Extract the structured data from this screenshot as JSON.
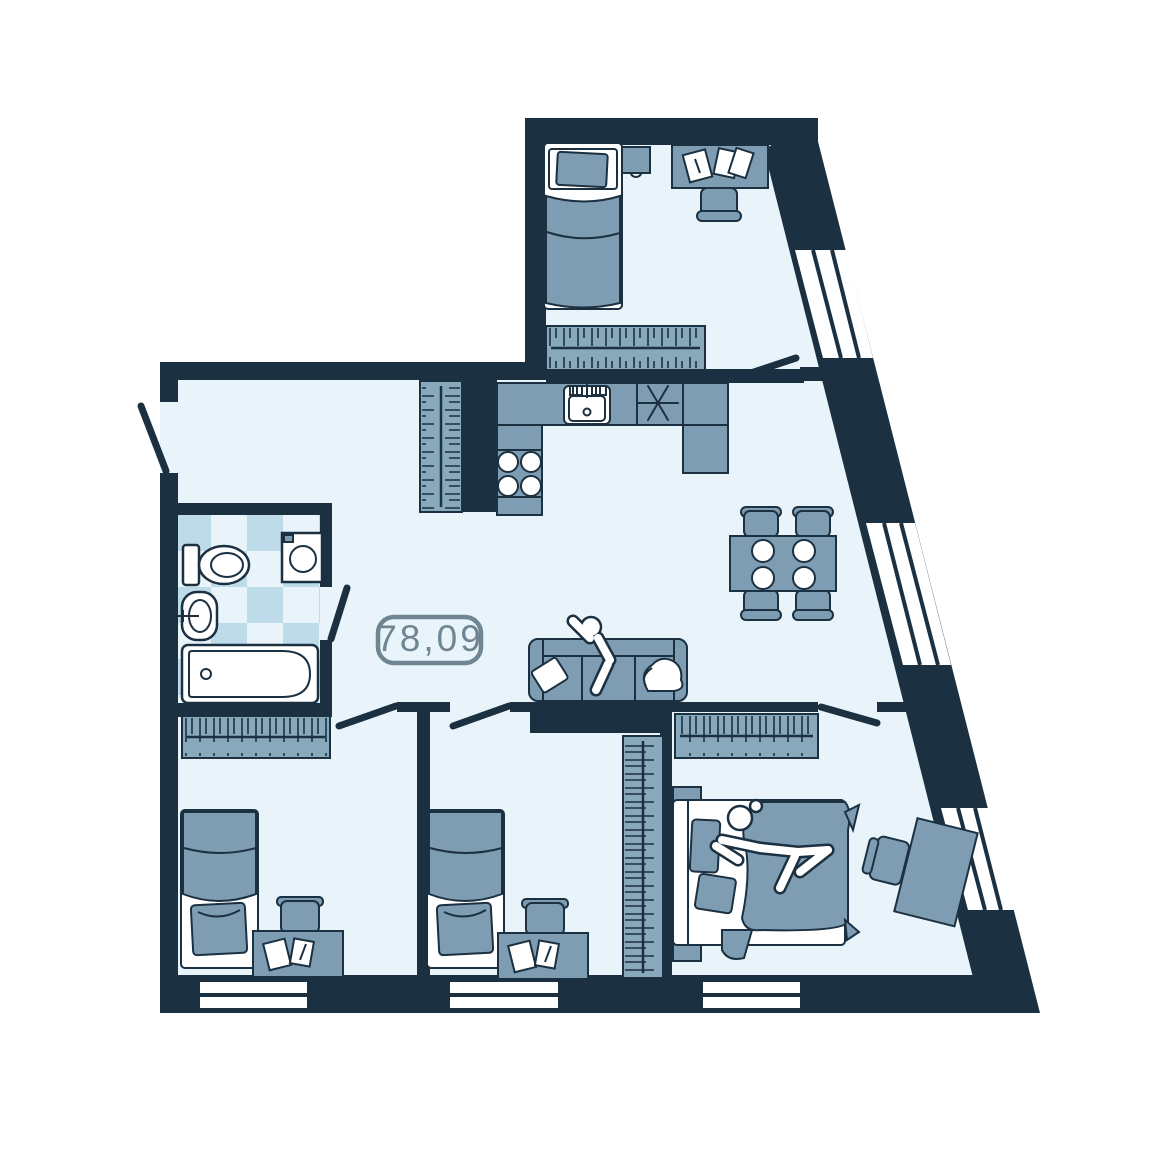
{
  "plan": {
    "area_label": "78,09",
    "type": "apartment-floor-plan"
  },
  "colors": {
    "background": "#ffffff",
    "wall": "#1b3040",
    "floor": "#e9f4fa",
    "furniture": "#7e9db2",
    "wardrobe": "#88a8bb",
    "fixture": "#ffffff",
    "tile": "#bedbea",
    "label": "#6f8592"
  },
  "rooms": [
    {
      "id": "bedroom-top",
      "furniture": [
        "single-bed",
        "nightstand",
        "desk",
        "desk-chair",
        "papers",
        "wardrobe",
        "window",
        "door"
      ]
    },
    {
      "id": "entry-hall",
      "furniture": [
        "entry-door",
        "wardrobe"
      ]
    },
    {
      "id": "kitchen",
      "furniture": [
        "counter",
        "kitchen-sink",
        "hob-symbol",
        "cooktop-burners"
      ]
    },
    {
      "id": "bathroom",
      "furniture": [
        "toilet",
        "washing-machine",
        "washbasin",
        "bathtub",
        "door",
        "tiled-floor"
      ]
    },
    {
      "id": "living-dining",
      "furniture": [
        "sofa",
        "sofa-pillow",
        "person",
        "dining-table",
        "dining-chair",
        "dining-chair",
        "dining-chair",
        "dining-chair",
        "plates"
      ]
    },
    {
      "id": "bedroom-left",
      "furniture": [
        "wardrobe",
        "single-bed",
        "desk",
        "desk-chair",
        "papers",
        "window",
        "door"
      ]
    },
    {
      "id": "bedroom-middle",
      "furniture": [
        "single-bed",
        "desk",
        "desk-chair",
        "papers",
        "wardrobe",
        "window",
        "door"
      ]
    },
    {
      "id": "bedroom-master",
      "furniture": [
        "wardrobe",
        "double-bed",
        "person",
        "nightstand",
        "nightstand",
        "desk",
        "desk-chair",
        "window",
        "door"
      ]
    }
  ]
}
